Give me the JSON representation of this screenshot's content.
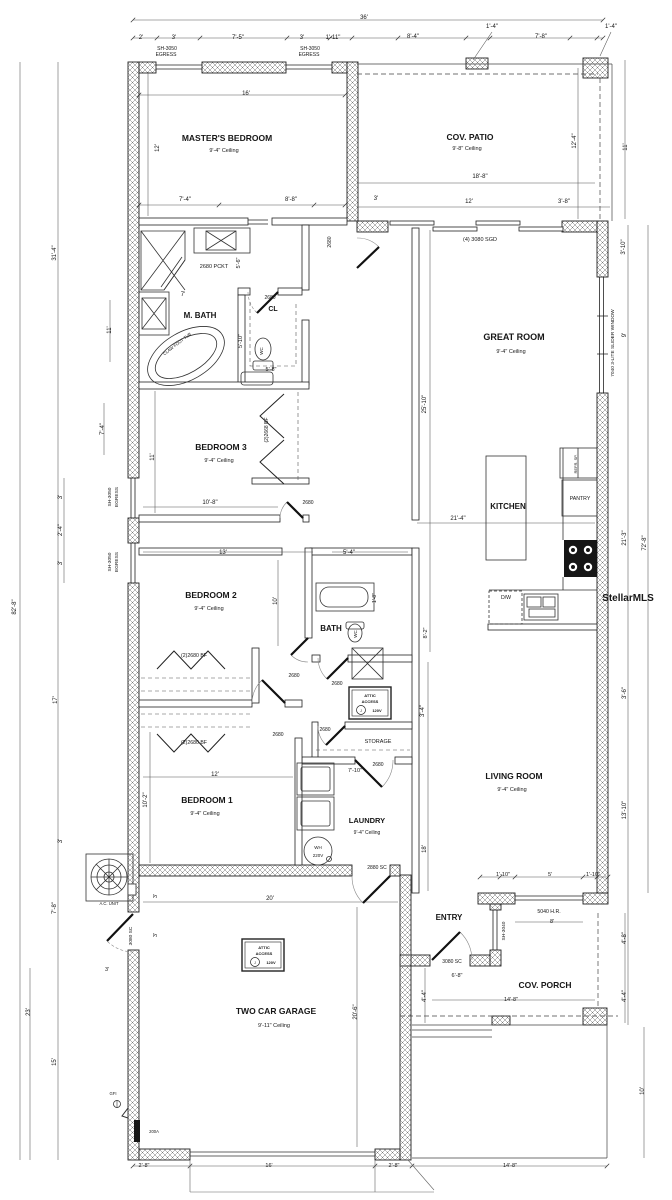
{
  "watermark": "StellarMLS",
  "plan_title": "Single family residence floor plan",
  "labels": [
    {
      "n": "dim-overall-width",
      "t": "36'",
      "x": 364,
      "y": 19,
      "s": 6
    },
    {
      "n": "dim-2ft",
      "t": "2'",
      "x": 141,
      "y": 39,
      "s": 6
    },
    {
      "n": "dim-3ft-a",
      "t": "3'",
      "x": 174,
      "y": 39,
      "s": 6
    },
    {
      "n": "dim-7ft5",
      "t": "7'-5\"",
      "x": 238,
      "y": 39,
      "s": 6
    },
    {
      "n": "dim-3ft-b",
      "t": "3'",
      "x": 302,
      "y": 39,
      "s": 6
    },
    {
      "n": "dim-1ft11",
      "t": "1'-11\"",
      "x": 333,
      "y": 39,
      "s": 6
    },
    {
      "n": "dim-8ft4",
      "t": "8'-4\"",
      "x": 413,
      "y": 38,
      "s": 6
    },
    {
      "n": "dim-1ft4-a",
      "t": "1'-4\"",
      "x": 492,
      "y": 28,
      "s": 6
    },
    {
      "n": "dim-7ft8-top",
      "t": "7'-8\"",
      "x": 541,
      "y": 38,
      "s": 6
    },
    {
      "n": "dim-1ft4-b",
      "t": "1'-4\"",
      "x": 611,
      "y": 28,
      "s": 6
    },
    {
      "n": "window-sh3050-1a",
      "t": "SH-3050",
      "x": 167,
      "y": 50,
      "s": 5
    },
    {
      "n": "window-sh3050-1b",
      "t": "EGRESS",
      "x": 166,
      "y": 56,
      "s": 5
    },
    {
      "n": "window-sh3050-2a",
      "t": "SH-3050",
      "x": 310,
      "y": 50,
      "s": 5
    },
    {
      "n": "window-sh3050-2b",
      "t": "EGRESS",
      "x": 309,
      "y": 56,
      "s": 5
    },
    {
      "n": "dim-16ft",
      "t": "16'",
      "x": 246,
      "y": 95,
      "s": 6
    },
    {
      "n": "dim-12ft-master",
      "t": "12'",
      "x": 159,
      "y": 148,
      "s": 6,
      "r": -90
    },
    {
      "n": "room-masters-bedroom",
      "t": "MASTER'S BEDROOM",
      "x": 227,
      "y": 141,
      "s": 8.5,
      "b": 1
    },
    {
      "n": "ceiling-masters-bedroom",
      "t": "9'-4\" Ceiling",
      "x": 224,
      "y": 152,
      "s": 5.5
    },
    {
      "n": "room-cov-patio",
      "t": "COV. PATIO",
      "x": 470,
      "y": 140,
      "s": 8.5,
      "b": 1
    },
    {
      "n": "ceiling-cov-patio",
      "t": "9'-8\" Ceiling",
      "x": 467,
      "y": 150,
      "s": 5.5
    },
    {
      "n": "dim-12ft4",
      "t": "12'-4\"",
      "x": 576,
      "y": 141,
      "s": 6,
      "r": -90
    },
    {
      "n": "dim-11ft-patio",
      "t": "11'",
      "x": 627,
      "y": 147,
      "s": 6,
      "r": -90
    },
    {
      "n": "dim-18ft8",
      "t": "18'-8\"",
      "x": 480,
      "y": 178,
      "s": 6
    },
    {
      "n": "dim-7ft4-master",
      "t": "7'-4\"",
      "x": 185,
      "y": 201,
      "s": 6
    },
    {
      "n": "dim-8ft8",
      "t": "8'-8\"",
      "x": 291,
      "y": 201,
      "s": 6
    },
    {
      "n": "dim-3ft-c",
      "t": "3'",
      "x": 376,
      "y": 200,
      "s": 6
    },
    {
      "n": "dim-12ft-patio",
      "t": "12'",
      "x": 469,
      "y": 203,
      "s": 6
    },
    {
      "n": "dim-3ft8",
      "t": "3'-8\"",
      "x": 564,
      "y": 203,
      "s": 6
    },
    {
      "n": "door-sgd",
      "t": "(4) 3080 SGD",
      "x": 480,
      "y": 241,
      "s": 5.5
    },
    {
      "n": "dim-3ft10",
      "t": "3'-10\"",
      "x": 625,
      "y": 247,
      "s": 6,
      "r": -90
    },
    {
      "n": "door-2680-master",
      "t": "2680",
      "x": 331,
      "y": 242,
      "s": 5,
      "r": -90
    },
    {
      "n": "door-2680-pocket",
      "t": "2680 PCKT",
      "x": 214,
      "y": 268,
      "s": 5.5
    },
    {
      "n": "dim-5ft6",
      "t": "5'-6\"",
      "x": 240,
      "y": 263,
      "s": 5.5,
      "r": -90
    },
    {
      "n": "dim-7ft-mbath",
      "t": "7'",
      "x": 183,
      "y": 296,
      "s": 6
    },
    {
      "n": "room-m-bath",
      "t": "M. BATH",
      "x": 200,
      "y": 318,
      "s": 8,
      "b": 1
    },
    {
      "n": "door-2680-cl",
      "t": "2680",
      "x": 270,
      "y": 299,
      "s": 5
    },
    {
      "n": "room-cl",
      "t": "CL",
      "x": 273,
      "y": 311,
      "s": 7,
      "b": 1
    },
    {
      "n": "fixture-clawfoot-tub",
      "t": "CLAW FOOT TUB",
      "x": 178,
      "y": 345,
      "s": 4.2,
      "r": -38
    },
    {
      "n": "fixture-wc-master",
      "t": "WC",
      "x": 263,
      "y": 351,
      "s": 4.5,
      "r": -90
    },
    {
      "n": "dim-5ft10",
      "t": "5'-10\"",
      "x": 242,
      "y": 341,
      "s": 5.5,
      "r": -90
    },
    {
      "n": "dim-5ft8",
      "t": "5'-8\"",
      "x": 271,
      "y": 371,
      "s": 5.5
    },
    {
      "n": "room-great-room",
      "t": "GREAT ROOM",
      "x": 514,
      "y": 340,
      "s": 9,
      "b": 1
    },
    {
      "n": "ceiling-great-room",
      "t": "9'-4\" Ceiling",
      "x": 511,
      "y": 353,
      "s": 5.5
    },
    {
      "n": "window-7040-slider",
      "t": "7040 3-LITE SLIDER WINDOW",
      "x": 614,
      "y": 343,
      "s": 4.8,
      "r": -90
    },
    {
      "n": "dim-9ft",
      "t": "9'",
      "x": 626,
      "y": 335,
      "s": 6,
      "r": -90
    },
    {
      "n": "dim-25ft10",
      "t": "25'-10\"",
      "x": 426,
      "y": 404,
      "s": 6,
      "r": -90
    },
    {
      "n": "room-bedroom-3",
      "t": "BEDROOM 3",
      "x": 221,
      "y": 450,
      "s": 8.5,
      "b": 1
    },
    {
      "n": "ceiling-bedroom-3",
      "t": "9'-4\" Ceiling",
      "x": 219,
      "y": 462,
      "s": 5.5
    },
    {
      "n": "dim-11ft-bed3",
      "t": "11'",
      "x": 154,
      "y": 457,
      "s": 6,
      "r": -90
    },
    {
      "n": "door-2668-bifold",
      "t": "(2)2668 BF",
      "x": 268,
      "y": 430,
      "s": 5,
      "r": -90
    },
    {
      "n": "dim-10ft8",
      "t": "10'-8\"",
      "x": 210,
      "y": 504,
      "s": 6
    },
    {
      "n": "door-2680-bed3",
      "t": "2680",
      "x": 308,
      "y": 504,
      "s": 5
    },
    {
      "n": "window-sh3050-3a",
      "t": "SH-3050",
      "x": 111,
      "y": 497,
      "s": 4.8,
      "r": -90
    },
    {
      "n": "window-sh3050-3b",
      "t": "EGRESS",
      "x": 118,
      "y": 497,
      "s": 4.8,
      "r": -90
    },
    {
      "n": "window-sh3050-4a",
      "t": "SH-3050",
      "x": 111,
      "y": 562,
      "s": 4.8,
      "r": -90
    },
    {
      "n": "window-sh3050-4b",
      "t": "EGRESS",
      "x": 118,
      "y": 562,
      "s": 4.8,
      "r": -90
    },
    {
      "n": "dim-3ft-d",
      "t": "3'",
      "x": 62,
      "y": 497,
      "s": 6,
      "r": -90
    },
    {
      "n": "dim-2ft4",
      "t": "2'-4\"",
      "x": 62,
      "y": 530,
      "s": 6,
      "r": -90
    },
    {
      "n": "dim-3ft-e",
      "t": "3'",
      "x": 62,
      "y": 563,
      "s": 6,
      "r": -90
    },
    {
      "n": "dim-7ft4-left",
      "t": "7'-4\"",
      "x": 104,
      "y": 429,
      "s": 6,
      "r": -90
    },
    {
      "n": "dim-11ft-left",
      "t": "11'",
      "x": 111,
      "y": 330,
      "s": 6,
      "r": -90
    },
    {
      "n": "dim-31ft4",
      "t": "31'-4\"",
      "x": 56,
      "y": 253,
      "s": 6,
      "r": -90
    },
    {
      "n": "dim-82ft8",
      "t": "82'-8\"",
      "x": 16,
      "y": 607,
      "s": 6,
      "r": -90
    },
    {
      "n": "room-kitchen",
      "t": "KITCHEN",
      "x": 508,
      "y": 509,
      "s": 8,
      "b": 1
    },
    {
      "n": "dim-21ft4",
      "t": "21'-4\"",
      "x": 458,
      "y": 520,
      "s": 6
    },
    {
      "n": "room-pantry",
      "t": "PANTRY",
      "x": 580,
      "y": 500,
      "s": 5.2
    },
    {
      "n": "fixture-refrigerator",
      "t": "REFR. SP.",
      "x": 577,
      "y": 464,
      "s": 4,
      "r": -90
    },
    {
      "n": "dim-21ft3",
      "t": "21'-3\"",
      "x": 626,
      "y": 538,
      "s": 6,
      "r": -90
    },
    {
      "n": "dim-72ft8",
      "t": "72'-8\"",
      "x": 646,
      "y": 543,
      "s": 6,
      "r": -90
    },
    {
      "n": "fixture-dishwasher",
      "t": "D/W",
      "x": 506,
      "y": 599,
      "s": 5.2
    },
    {
      "n": "dim-13ft",
      "t": "13'",
      "x": 223,
      "y": 554,
      "s": 6
    },
    {
      "n": "dim-5ft4",
      "t": "5'-4\"",
      "x": 349,
      "y": 554,
      "s": 6
    },
    {
      "n": "room-bedroom-2",
      "t": "BEDROOM 2",
      "x": 211,
      "y": 598,
      "s": 8.5,
      "b": 1
    },
    {
      "n": "ceiling-bedroom-2",
      "t": "9'-4\" Ceiling",
      "x": 209,
      "y": 610,
      "s": 5.5
    },
    {
      "n": "dim-10ft-bed2",
      "t": "10'",
      "x": 277,
      "y": 601,
      "s": 6,
      "r": -90
    },
    {
      "n": "dim-1ft8",
      "t": "1'-8\"",
      "x": 376,
      "y": 598,
      "s": 5,
      "r": -90
    },
    {
      "n": "room-bath",
      "t": "BATH",
      "x": 331,
      "y": 631,
      "s": 8,
      "b": 1
    },
    {
      "n": "fixture-wc-bath",
      "t": "WC",
      "x": 357,
      "y": 634,
      "s": 4.5,
      "r": -90
    },
    {
      "n": "door-2680-bifold-a",
      "t": "(2)2680 BF",
      "x": 194,
      "y": 657,
      "s": 5.2
    },
    {
      "n": "door-2680-bed2",
      "t": "2680",
      "x": 294,
      "y": 677,
      "s": 5
    },
    {
      "n": "door-2680-bath",
      "t": "2680",
      "x": 337,
      "y": 685,
      "s": 5
    },
    {
      "n": "badge1-attic",
      "t": "ATTIC",
      "x": 370,
      "y": 697,
      "s": 4,
      "b": 1
    },
    {
      "n": "badge1-access",
      "t": "ACCESS",
      "x": 370,
      "y": 703,
      "s": 4,
      "b": 1
    },
    {
      "n": "badge1-120v",
      "t": "120V",
      "x": 377,
      "y": 712,
      "s": 4,
      "b": 1
    },
    {
      "n": "badge1-j",
      "t": "J",
      "x": 361,
      "y": 712,
      "s": 3.5
    },
    {
      "n": "dim-3ft4",
      "t": "3'-4\"",
      "x": 424,
      "y": 711,
      "s": 6,
      "r": -90
    },
    {
      "n": "room-storage",
      "t": "STORAGE",
      "x": 378,
      "y": 743,
      "s": 5.5
    },
    {
      "n": "door-2680-storage",
      "t": "2680",
      "x": 325,
      "y": 731,
      "s": 5
    },
    {
      "n": "door-2680-bed1",
      "t": "2680",
      "x": 278,
      "y": 736,
      "s": 5
    },
    {
      "n": "door-2680-bifold-b",
      "t": "(2)2680 BF",
      "x": 194,
      "y": 744,
      "s": 5.2
    },
    {
      "n": "dim-17ft",
      "t": "17'",
      "x": 57,
      "y": 700,
      "s": 6,
      "r": -90
    },
    {
      "n": "door-2680-laundry",
      "t": "2680",
      "x": 378,
      "y": 766,
      "s": 5
    },
    {
      "n": "dim-7ft10",
      "t": "7'-10\"",
      "x": 355,
      "y": 772,
      "s": 5.5
    },
    {
      "n": "dim-12ft-bed1",
      "t": "12'",
      "x": 215,
      "y": 776,
      "s": 6
    },
    {
      "n": "room-bedroom-1",
      "t": "BEDROOM 1",
      "x": 207,
      "y": 803,
      "s": 8.5,
      "b": 1
    },
    {
      "n": "ceiling-bedroom-1",
      "t": "9'-4\" Ceiling",
      "x": 205,
      "y": 815,
      "s": 5.5
    },
    {
      "n": "dim-10ft2",
      "t": "10'-2\"",
      "x": 147,
      "y": 800,
      "s": 6,
      "r": -90
    },
    {
      "n": "room-laundry",
      "t": "LAUNDRY",
      "x": 367,
      "y": 823,
      "s": 7.5,
      "b": 1
    },
    {
      "n": "ceiling-laundry",
      "t": "9'-4\" Ceiling",
      "x": 367,
      "y": 834,
      "s": 5
    },
    {
      "n": "fixture-wh",
      "t": "WH",
      "x": 318,
      "y": 849,
      "s": 4.5
    },
    {
      "n": "fixture-wh-220v",
      "t": "220V",
      "x": 318,
      "y": 857,
      "s": 4.5
    },
    {
      "n": "room-living-room",
      "t": "LIVING ROOM",
      "x": 514,
      "y": 779,
      "s": 8.5,
      "b": 1
    },
    {
      "n": "ceiling-living-room",
      "t": "9'-4\" Ceiling",
      "x": 512,
      "y": 791,
      "s": 5.5
    },
    {
      "n": "dim-18ft",
      "t": "18'",
      "x": 426,
      "y": 849,
      "s": 6,
      "r": -90
    },
    {
      "n": "dim-13ft10",
      "t": "13'-10\"",
      "x": 626,
      "y": 810,
      "s": 6,
      "r": -90
    },
    {
      "n": "dim-3ft6",
      "t": "3'-6\"",
      "x": 626,
      "y": 693,
      "s": 6,
      "r": -90
    },
    {
      "n": "dim-8ft2",
      "t": "8'-2\"",
      "x": 427,
      "y": 633,
      "s": 5.5,
      "r": -90
    },
    {
      "n": "door-2880-sc",
      "t": "2880 SC",
      "x": 377,
      "y": 869,
      "s": 5
    },
    {
      "n": "dim-1ft10-a",
      "t": "1'-10\"",
      "x": 503,
      "y": 876,
      "s": 5.5
    },
    {
      "n": "dim-5ft-window",
      "t": "5'",
      "x": 550,
      "y": 876,
      "s": 5.5
    },
    {
      "n": "dim-1ft10-b",
      "t": "1'-10\"",
      "x": 593,
      "y": 876,
      "s": 5.5
    },
    {
      "n": "window-5040-hr",
      "t": "5040 H.R.",
      "x": 549,
      "y": 913,
      "s": 5.2
    },
    {
      "n": "dim-8ft-porch",
      "t": "8'",
      "x": 552,
      "y": 923,
      "s": 5.5
    },
    {
      "n": "window-sh3040",
      "t": "SH-3040",
      "x": 505,
      "y": 931,
      "s": 4.8,
      "r": -90
    },
    {
      "n": "room-entry",
      "t": "ENTRY",
      "x": 449,
      "y": 920,
      "s": 8,
      "b": 1
    },
    {
      "n": "door-3080-sc-entry",
      "t": "3080 SC",
      "x": 452,
      "y": 963,
      "s": 5
    },
    {
      "n": "dim-6ft8",
      "t": "6'-8\"",
      "x": 457,
      "y": 977,
      "s": 5.5
    },
    {
      "n": "room-cov-porch",
      "t": "COV. PORCH",
      "x": 545,
      "y": 988,
      "s": 8.5,
      "b": 1
    },
    {
      "n": "dim-14ft8-a",
      "t": "14'-8\"",
      "x": 511,
      "y": 1001,
      "s": 5.5
    },
    {
      "n": "dim-4ft8",
      "t": "4'-8\"",
      "x": 626,
      "y": 938,
      "s": 6,
      "r": -90
    },
    {
      "n": "dim-4ft4-a",
      "t": "4'-4\"",
      "x": 626,
      "y": 996,
      "s": 6,
      "r": -90
    },
    {
      "n": "dim-4ft4-b",
      "t": "4'-4\"",
      "x": 426,
      "y": 996,
      "s": 6,
      "r": -90
    },
    {
      "n": "dim-10ft-porch",
      "t": "10'",
      "x": 644,
      "y": 1091,
      "s": 6,
      "r": -90
    },
    {
      "n": "dim-14ft8-b",
      "t": "14'-8\"",
      "x": 510,
      "y": 1167,
      "s": 5.5
    },
    {
      "n": "fixture-ac-unit",
      "t": "A.C. UNIT",
      "x": 109,
      "y": 905,
      "s": 4.2
    },
    {
      "n": "door-3080-sc-garage",
      "t": "3080 SC",
      "x": 132,
      "y": 936,
      "s": 4.8,
      "r": -90
    },
    {
      "n": "dim-3ft-f",
      "t": "3'",
      "x": 157,
      "y": 896,
      "s": 5.5,
      "r": -90
    },
    {
      "n": "dim-3ft-g",
      "t": "3'",
      "x": 157,
      "y": 935,
      "s": 5.5,
      "r": -90
    },
    {
      "n": "dim-20ft",
      "t": "20'",
      "x": 270,
      "y": 900,
      "s": 6
    },
    {
      "n": "dim-7ft8-left",
      "t": "7'-8\"",
      "x": 56,
      "y": 908,
      "s": 6,
      "r": -90
    },
    {
      "n": "dim-3ft-h",
      "t": "3'",
      "x": 62,
      "y": 841,
      "s": 6,
      "r": -90
    },
    {
      "n": "dim-3ft-i",
      "t": "3'",
      "x": 107,
      "y": 971,
      "s": 5.5
    },
    {
      "n": "dim-23ft",
      "t": "23'",
      "x": 30,
      "y": 1012,
      "s": 6,
      "r": -90
    },
    {
      "n": "dim-15ft",
      "t": "15'",
      "x": 56,
      "y": 1062,
      "s": 6,
      "r": -90
    },
    {
      "n": "room-two-car-garage",
      "t": "TWO CAR GARAGE",
      "x": 276,
      "y": 1014,
      "s": 8.5,
      "b": 1
    },
    {
      "n": "ceiling-garage",
      "t": "9'-11\" Ceiling",
      "x": 274,
      "y": 1027,
      "s": 5.5
    },
    {
      "n": "dim-20ft6",
      "t": "20'-6\"",
      "x": 357,
      "y": 1012,
      "s": 6,
      "r": -90
    },
    {
      "n": "badge2-attic",
      "t": "ATTIC",
      "x": 264,
      "y": 949,
      "s": 4,
      "b": 1
    },
    {
      "n": "badge2-access",
      "t": "ACCESS",
      "x": 264,
      "y": 955,
      "s": 4,
      "b": 1
    },
    {
      "n": "badge2-120v",
      "t": "120V",
      "x": 271,
      "y": 964,
      "s": 4,
      "b": 1
    },
    {
      "n": "badge2-j",
      "t": "J",
      "x": 255,
      "y": 964,
      "s": 3.5
    },
    {
      "n": "fixture-gfi",
      "t": "GFI",
      "x": 113,
      "y": 1095,
      "s": 4.2
    },
    {
      "n": "fixture-200a-panel",
      "t": "200A",
      "x": 154,
      "y": 1133,
      "s": 4.2
    },
    {
      "n": "dim-2ft8-a",
      "t": "2'-8\"",
      "x": 144,
      "y": 1167,
      "s": 5.5
    },
    {
      "n": "dim-16ft-garage-door",
      "t": "16'",
      "x": 269,
      "y": 1167,
      "s": 5.5
    },
    {
      "n": "dim-2ft8-b",
      "t": "2'-8\"",
      "x": 394,
      "y": 1167,
      "s": 5.5
    },
    {
      "n": "watermark",
      "t": "StellarMLS",
      "x": 628,
      "y": 601,
      "s": 10,
      "b": 1,
      "c": "#d2d2d2"
    }
  ]
}
